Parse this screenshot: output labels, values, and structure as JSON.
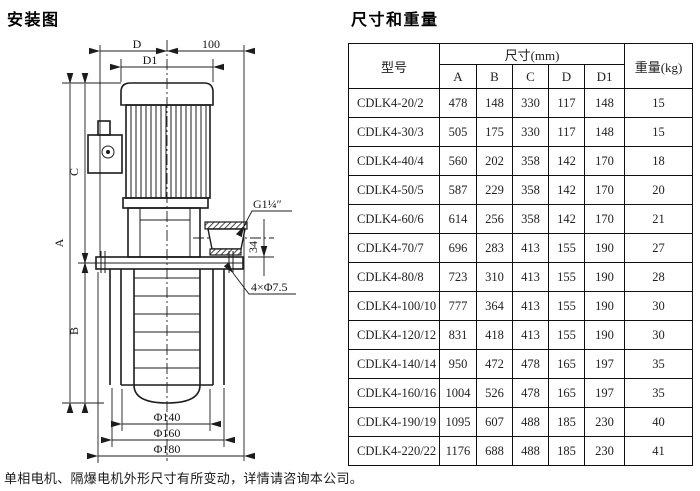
{
  "left": {
    "title": "安装图",
    "footnote": "单相电机、隔爆电机外形尺寸有所变动，详情请咨询本公司。",
    "labels": {
      "dim_d": "D",
      "dim_100": "100",
      "dim_d1": "D1",
      "dim_a": "A",
      "dim_b": "B",
      "dim_c": "C",
      "dim_g": "G1¼″",
      "dim_34": "34",
      "dim_holes": "4×Φ7.5",
      "dim_phi140": "Φ140",
      "dim_phi160": "Φ160",
      "dim_phi180": "Φ180"
    }
  },
  "table": {
    "title": "尺寸和重量",
    "header": {
      "model": "型号",
      "size_group": "尺寸(mm)",
      "weight": "重量(kg)",
      "cols": [
        "A",
        "B",
        "C",
        "D",
        "D1"
      ]
    },
    "rows": [
      [
        "CDLK4-20/2",
        "478",
        "148",
        "330",
        "117",
        "148",
        "15"
      ],
      [
        "CDLK4-30/3",
        "505",
        "175",
        "330",
        "117",
        "148",
        "15"
      ],
      [
        "CDLK4-40/4",
        "560",
        "202",
        "358",
        "142",
        "170",
        "18"
      ],
      [
        "CDLK4-50/5",
        "587",
        "229",
        "358",
        "142",
        "170",
        "20"
      ],
      [
        "CDLK4-60/6",
        "614",
        "256",
        "358",
        "142",
        "170",
        "21"
      ],
      [
        "CDLK4-70/7",
        "696",
        "283",
        "413",
        "155",
        "190",
        "27"
      ],
      [
        "CDLK4-80/8",
        "723",
        "310",
        "413",
        "155",
        "190",
        "28"
      ],
      [
        "CDLK4-100/10",
        "777",
        "364",
        "413",
        "155",
        "190",
        "30"
      ],
      [
        "CDLK4-120/12",
        "831",
        "418",
        "413",
        "155",
        "190",
        "30"
      ],
      [
        "CDLK4-140/14",
        "950",
        "472",
        "478",
        "165",
        "197",
        "35"
      ],
      [
        "CDLK4-160/16",
        "1004",
        "526",
        "478",
        "165",
        "197",
        "35"
      ],
      [
        "CDLK4-190/19",
        "1095",
        "607",
        "488",
        "185",
        "230",
        "40"
      ],
      [
        "CDLK4-220/22",
        "1176",
        "688",
        "488",
        "185",
        "230",
        "41"
      ]
    ]
  }
}
